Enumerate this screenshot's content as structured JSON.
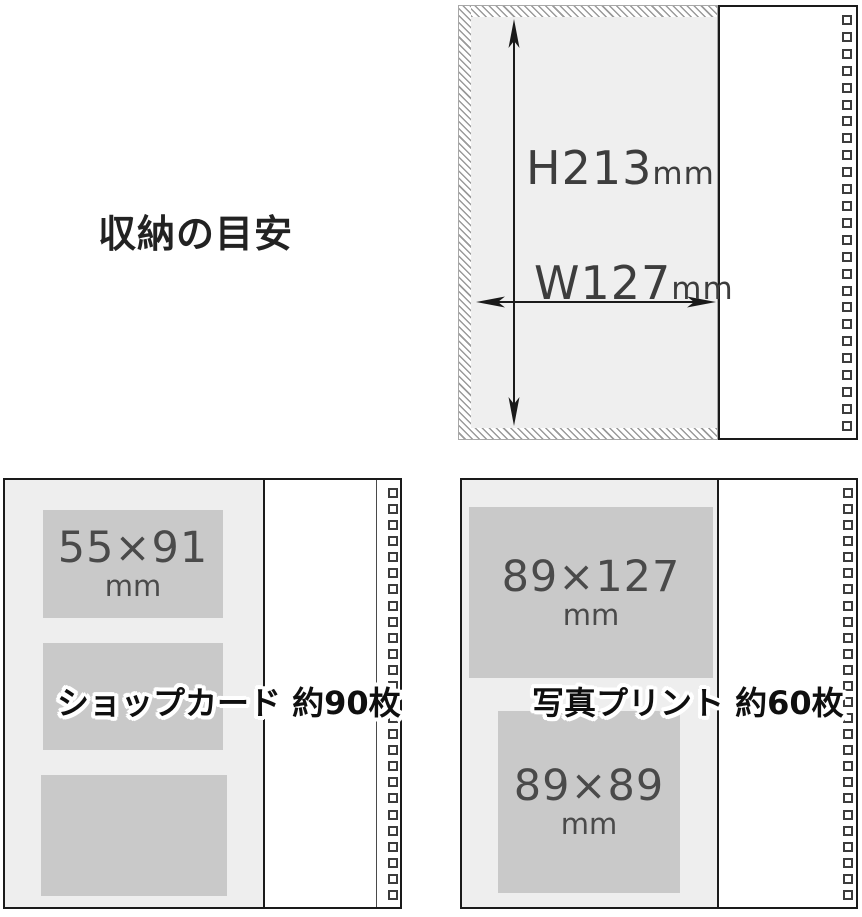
{
  "page": {
    "title": "収納の目安"
  },
  "top_panel": {
    "height": {
      "value": "H213",
      "unit": "mm"
    },
    "width": {
      "value": "W127",
      "unit": "mm"
    }
  },
  "shop_card_panel": {
    "card": {
      "size": "55×91",
      "unit": "mm"
    },
    "caption": "ショップカード 約90枚"
  },
  "photo_panel": {
    "large_print": {
      "size": "89×127",
      "unit": "mm"
    },
    "small_print": {
      "size": "89×89",
      "unit": "mm"
    },
    "caption": "写真プリント 約60枚"
  },
  "colors": {
    "panel_bg": "#efefef",
    "card_bg": "#c9c9c9",
    "outline": "#1a1a1a",
    "dimension_text": "#3d3d3d",
    "caption_text": "#0f0f0f"
  }
}
